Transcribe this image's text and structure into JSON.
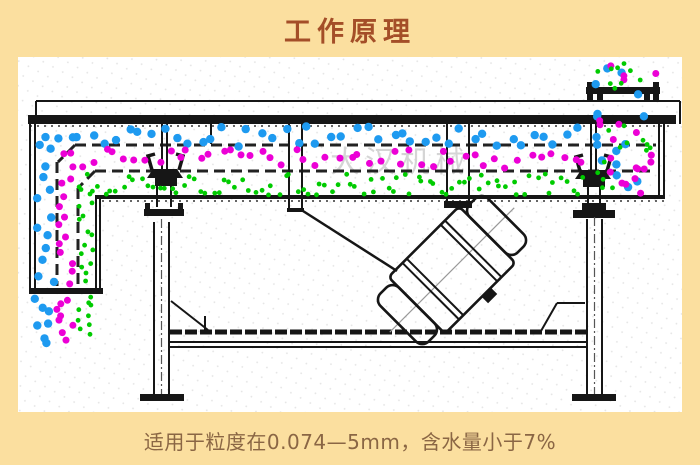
{
  "page": {
    "title": "工作原理",
    "caption": "适用于粒度在0.074—5mm，含水量小于7%",
    "watermark": "大汉机械"
  },
  "colors": {
    "background": "#fbdf9f",
    "title_text": "#a44e28",
    "caption_text": "#8a6644",
    "line_ink": "#161616",
    "coarse_particles": "#1e9af0",
    "medium_particles": "#ec00d6",
    "fine_particles": "#00cb00",
    "watermark": "#c6c6c6"
  },
  "diagram": {
    "description_layers": [
      {
        "name": "coarse-layer",
        "color_key": "coarse_particles"
      },
      {
        "name": "medium-layer",
        "color_key": "medium_particles"
      },
      {
        "name": "fine-layer",
        "color_key": "fine_particles"
      }
    ],
    "particle_bands": [
      {
        "name": "blue-top-layer",
        "color": "coarse_particles",
        "x0": 40,
        "x1": 588,
        "y0": 126,
        "y1": 147,
        "r": 4.2,
        "n": 46,
        "axis": "x",
        "seed": 11
      },
      {
        "name": "magenta-mid-layer",
        "color": "medium_particles",
        "x0": 58,
        "x1": 588,
        "y0": 149,
        "y1": 169,
        "r": 3.5,
        "n": 50,
        "axis": "x",
        "seed": 22
      },
      {
        "name": "green-bottom-layer",
        "color": "fine_particles",
        "x0": 78,
        "x1": 588,
        "y0": 174,
        "y1": 195,
        "r": 2.4,
        "n": 85,
        "axis": "x",
        "seed": 33
      },
      {
        "name": "blue-left-channel",
        "color": "coarse_particles",
        "x0": 37,
        "x1": 54,
        "y0": 136,
        "y1": 290,
        "r": 4.2,
        "n": 13,
        "axis": "y",
        "seed": 44
      },
      {
        "name": "magenta-left-channel",
        "color": "medium_particles",
        "x0": 58,
        "x1": 75,
        "y0": 163,
        "y1": 290,
        "r": 3.5,
        "n": 13,
        "axis": "y",
        "seed": 55
      },
      {
        "name": "green-left-channel",
        "color": "fine_particles",
        "x0": 79,
        "x1": 94,
        "y0": 186,
        "y1": 286,
        "r": 2.4,
        "n": 15,
        "axis": "y",
        "seed": 66
      },
      {
        "name": "blue-discharge",
        "color": "coarse_particles",
        "x0": 34,
        "x1": 52,
        "y0": 296,
        "y1": 347,
        "r": 4.2,
        "n": 7,
        "axis": "y",
        "seed": 77
      },
      {
        "name": "magenta-discharge",
        "color": "medium_particles",
        "x0": 53,
        "x1": 74,
        "y0": 296,
        "y1": 342,
        "r": 3.5,
        "n": 8,
        "axis": "y",
        "seed": 88
      },
      {
        "name": "green-discharge",
        "color": "fine_particles",
        "x0": 77,
        "x1": 94,
        "y0": 296,
        "y1": 337,
        "r": 2.4,
        "n": 9,
        "axis": "y",
        "seed": 99
      },
      {
        "name": "feed-blue",
        "color": "coarse_particles",
        "x0": 594,
        "x1": 652,
        "y0": 58,
        "y1": 192,
        "r": 4.2,
        "n": 16,
        "axis": "r",
        "seed": 101
      },
      {
        "name": "feed-magenta",
        "color": "medium_particles",
        "x0": 593,
        "x1": 656,
        "y0": 58,
        "y1": 195,
        "r": 3.5,
        "n": 20,
        "axis": "r",
        "seed": 102
      },
      {
        "name": "feed-green",
        "color": "fine_particles",
        "x0": 595,
        "x1": 656,
        "y0": 60,
        "y1": 195,
        "r": 2.4,
        "n": 22,
        "axis": "r",
        "seed": 103
      }
    ]
  }
}
